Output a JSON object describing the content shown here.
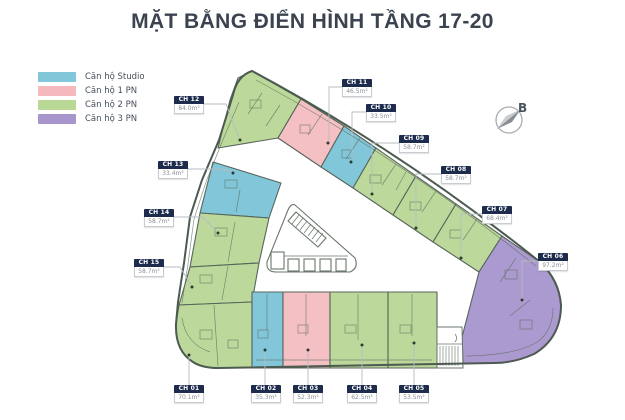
{
  "title": "MẶT BẰNG ĐIỂN HÌNH TẦNG 17-20",
  "compass": {
    "north_label": "B"
  },
  "legend": {
    "items": [
      {
        "label": "Căn hộ Studio",
        "color": "#82c6da"
      },
      {
        "label": "Căn hộ 1 PN",
        "color": "#f5b9bd"
      },
      {
        "label": "Căn hộ 2 PN",
        "color": "#b9d795"
      },
      {
        "label": "Căn hộ 3 PN",
        "color": "#a795cb"
      }
    ]
  },
  "colors": {
    "studio": "#82c6da",
    "one_bedroom": "#f5c0c3",
    "two_bedroom": "#bcd99b",
    "three_bedroom": "#ab9ad0",
    "wall": "#55625a",
    "label_header": "#1d2c4d",
    "leader": "#b6bcc2"
  },
  "units": [
    {
      "id": "CH 01",
      "area": "70.1m²",
      "type": "Căn hộ 2 PN"
    },
    {
      "id": "CH 02",
      "area": "35.3m²",
      "type": "Căn hộ Studio"
    },
    {
      "id": "CH 03",
      "area": "52.3m²",
      "type": "Căn hộ 1 PN"
    },
    {
      "id": "CH 04",
      "area": "62.5m²",
      "type": "Căn hộ 2 PN"
    },
    {
      "id": "CH 05",
      "area": "53.5m²",
      "type": "Căn hộ 2 PN"
    },
    {
      "id": "CH 06",
      "area": "97.2m²",
      "type": "Căn hộ 3 PN"
    },
    {
      "id": "CH 07",
      "area": "68.4m²",
      "type": "Căn hộ 2 PN"
    },
    {
      "id": "CH 08",
      "area": "58.7m²",
      "type": "Căn hộ 2 PN"
    },
    {
      "id": "CH 09",
      "area": "58.7m²",
      "type": "Căn hộ 2 PN"
    },
    {
      "id": "CH 10",
      "area": "33.5m²",
      "type": "Căn hộ Studio"
    },
    {
      "id": "CH 11",
      "area": "46.5m²",
      "type": "Căn hộ 1 PN"
    },
    {
      "id": "CH 12",
      "area": "84.0m²",
      "type": "Căn hộ 2 PN"
    },
    {
      "id": "CH 13",
      "area": "33.4m²",
      "type": "Căn hộ Studio"
    },
    {
      "id": "CH 14",
      "area": "58.7m²",
      "type": "Căn hộ 2 PN"
    },
    {
      "id": "CH 15",
      "area": "58.7m²",
      "type": "Căn hộ 2 PN"
    }
  ]
}
